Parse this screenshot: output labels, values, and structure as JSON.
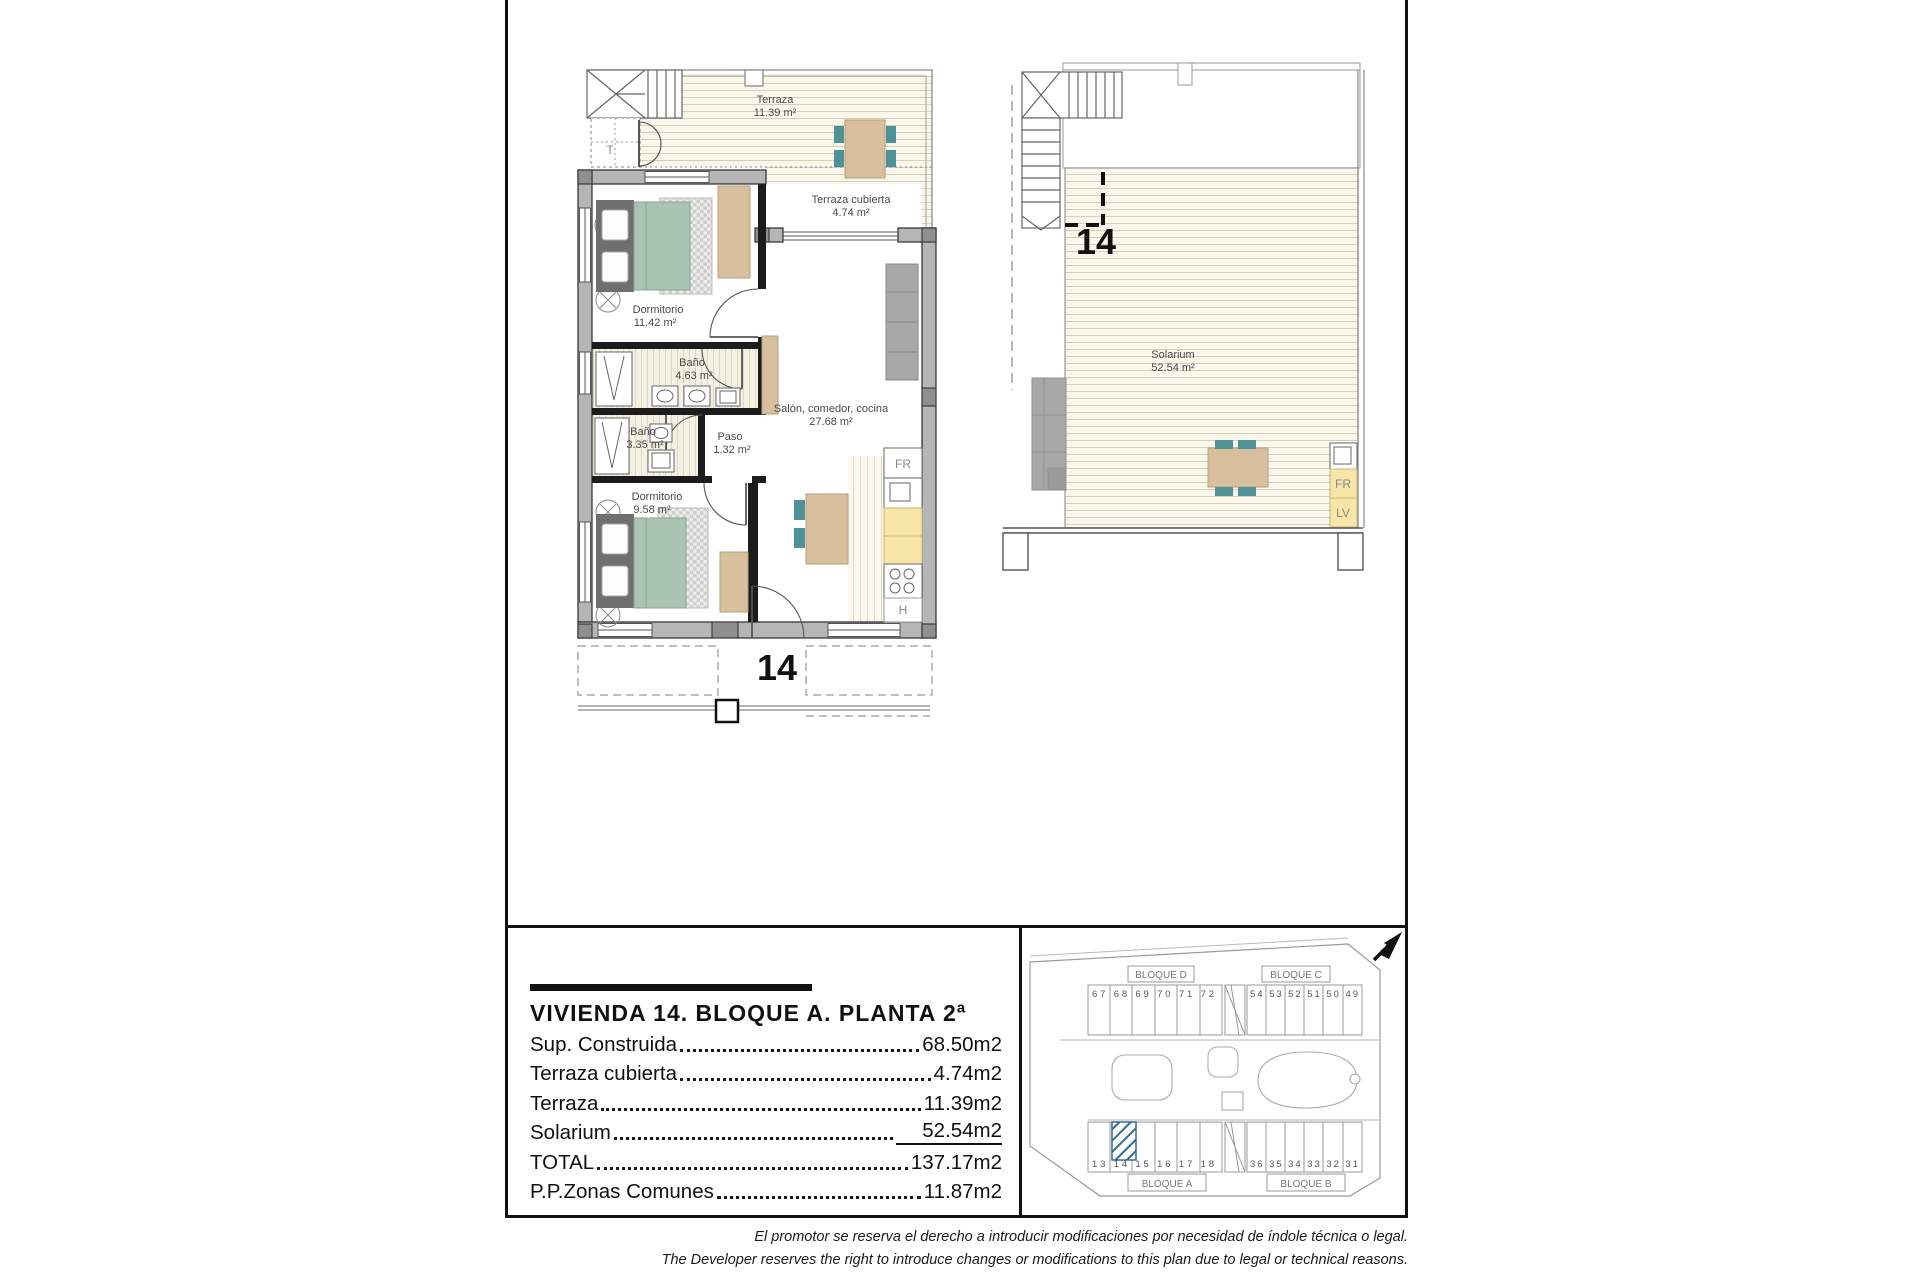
{
  "plans": {
    "main": {
      "unit": "14",
      "stair_label": "T",
      "fridge_label": "FR",
      "hob_label": "H",
      "rooms": [
        {
          "name": "Terraza",
          "area": "11.39 m²"
        },
        {
          "name": "Terraza cubierta",
          "area": "4.74 m²"
        },
        {
          "name": "Dormitorio",
          "area": "11.42 m²"
        },
        {
          "name": "Baño",
          "area": "4.63 m²"
        },
        {
          "name": "Baño",
          "area": "3.35 m²"
        },
        {
          "name": "Paso",
          "area": "1.32 m²"
        },
        {
          "name": "Dormitorio",
          "area": "9.58 m²"
        },
        {
          "name": "Salón, comedor, cocina",
          "area": "27.68 m²"
        }
      ]
    },
    "solarium": {
      "unit": "14",
      "room": {
        "name": "Solarium",
        "area": "52.54 m²"
      },
      "fridge_label": "FR",
      "dishwasher_label": "LV"
    }
  },
  "info_panel": {
    "title": "VIVIENDA 14. BLOQUE A. PLANTA 2ª",
    "rows": [
      {
        "label": "Sup. Construida",
        "value": "68.50m2"
      },
      {
        "label": "Terraza cubierta",
        "value": "4.74m2"
      },
      {
        "label": "Terraza",
        "value": "11.39m2"
      },
      {
        "label": "Solarium",
        "value": "52.54m2"
      },
      {
        "label": "TOTAL",
        "value": "137.17m2"
      },
      {
        "label": "P.P.Zonas Comunes",
        "value": "11.87m2"
      }
    ]
  },
  "site_plan": {
    "highlighted_unit": "14",
    "blocks": [
      {
        "label": "BLOQUE D",
        "units": "67 68 69 70 71 72"
      },
      {
        "label": "BLOQUE C",
        "units": "54 53 52 51 50 49"
      },
      {
        "label": "BLOQUE A",
        "units": "13 14 15 16 17 18"
      },
      {
        "label": "BLOQUE B",
        "units": "36 35 34 33 32 31"
      }
    ]
  },
  "disclaimer": {
    "es": "El promotor se reserva el derecho a introducir modificaciones por necesidad de índole técnica o legal.",
    "en": "The Developer reserves the right to introduce changes or modifications to this plan due to legal or technical reasons."
  },
  "colors": {
    "floor_stripe_bg": "#f9f7ec",
    "wall_gray": "#b5b5b5",
    "furniture_tan": "#d8bf9e",
    "bed_teal": "#a9c4b3",
    "chair_teal": "#4e9196",
    "counter_yellow": "#f7e6a8",
    "highlight_blue": "#2e6e96"
  }
}
